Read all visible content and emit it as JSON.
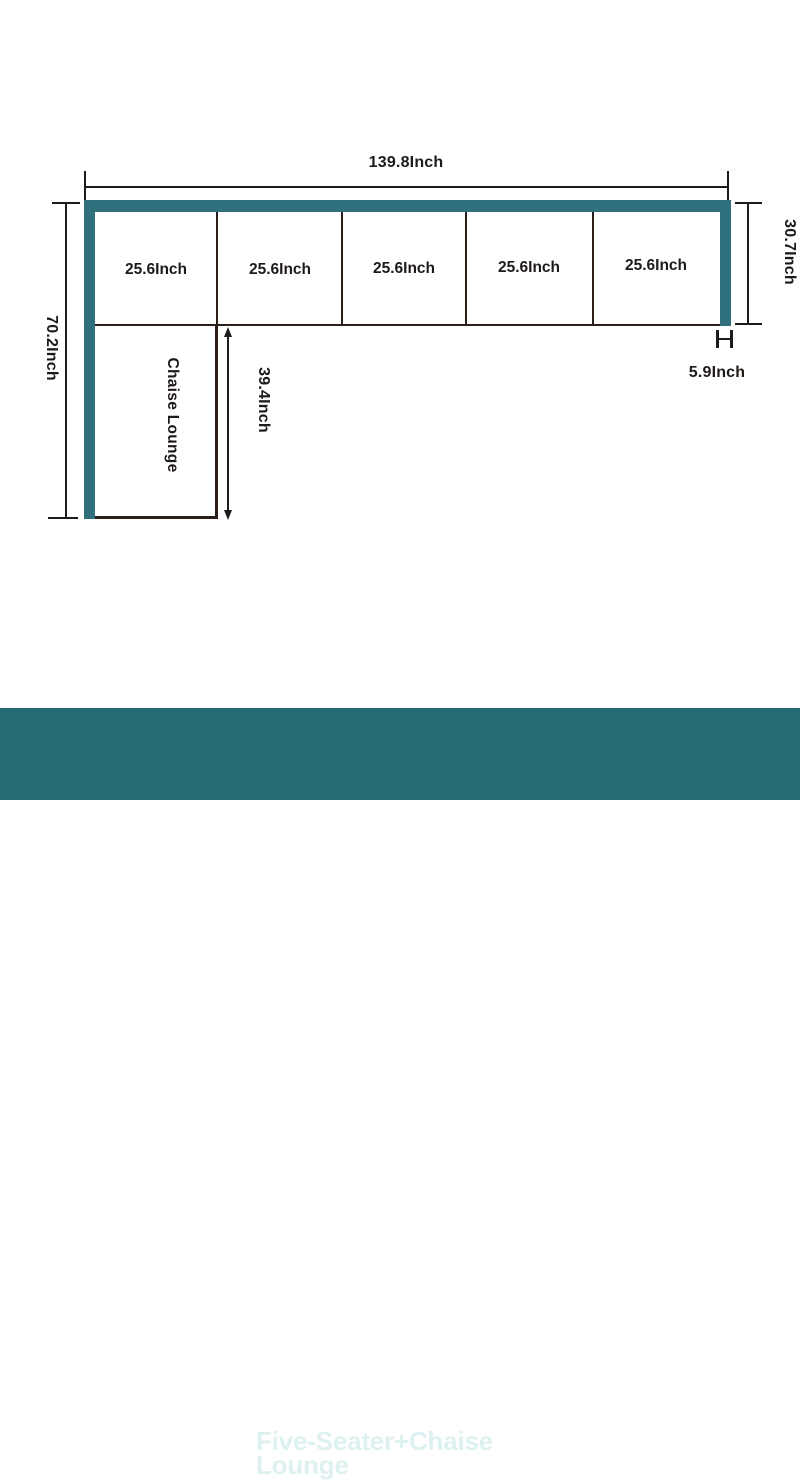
{
  "banner": {
    "title": "Five-Seater+Chaise Lounge",
    "bg_color": "#266b74",
    "text_color": "#def1f1"
  },
  "diagram": {
    "overall_width": "139.8Inch",
    "overall_depth": "70.2Inch",
    "seat_depth": "30.7Inch",
    "arm_width": "5.9Inch",
    "chaise_length": "39.4Inch",
    "chaise_label": "Chaise Lounge",
    "seats": [
      {
        "label": "25.6Inch"
      },
      {
        "label": "25.6Inch"
      },
      {
        "label": "25.6Inch"
      },
      {
        "label": "25.6Inch"
      },
      {
        "label": "25.6Inch"
      }
    ],
    "sofa_color": "#2f707c",
    "line_color": "#2b1e18"
  }
}
